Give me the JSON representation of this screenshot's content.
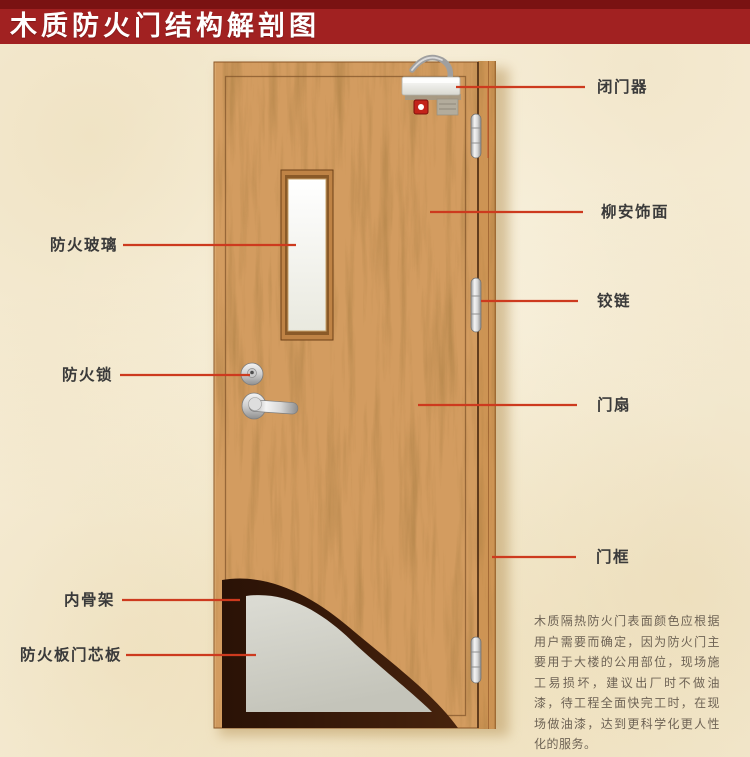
{
  "title": "木质防火门结构解剖图",
  "parts": {
    "left": [
      {
        "label": "防火玻璃"
      },
      {
        "label": "防火锁"
      },
      {
        "label": "内骨架"
      },
      {
        "label": "防火板门芯板"
      }
    ],
    "right": [
      {
        "label": "闭门器"
      },
      {
        "label": "柳安饰面"
      },
      {
        "label": "铰链"
      },
      {
        "label": "门扇"
      },
      {
        "label": "门框"
      }
    ]
  },
  "description": "木质隔热防火门表面颜色应根据用户需要而确定，因为防火门主要用于大楼的公用部位，现场施工易损坏，建议出厂时不做油漆，待工程全面快完工时，在现场做油漆，达到更科学化更人性化的服务。",
  "colors": {
    "banner_red": "#a12121",
    "banner_dark_red": "#7a1212",
    "leader_line_red": "#cd3a1e",
    "door_wood": "#d39c60",
    "fire_board_core": "#d2d2c8",
    "inner_skeleton": "#2c1307",
    "paper_background": "#f7efda"
  }
}
